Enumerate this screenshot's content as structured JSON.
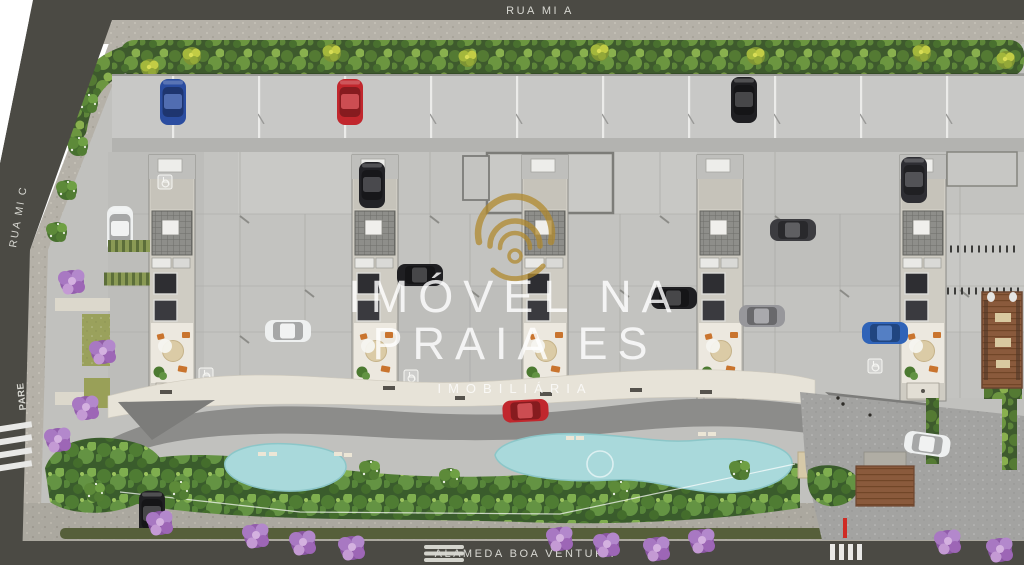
{
  "streets": {
    "top_label": "RUA MI A",
    "left_label": "RUA MI C",
    "bottom_label": "ALAMEDA BOA VENTURA"
  },
  "markings": {
    "stop_text": "PARE"
  },
  "watermark": {
    "line1": "IMÓVEL NA",
    "line2": "PRAIA ES",
    "line3": "IMOBILIÁRIA"
  },
  "colors": {
    "road": "#4b4a44",
    "site_concrete": "#c1c1be",
    "sidewalk": "#b5b1a8",
    "hedge_green": "#4a6c33",
    "lush_green": "#57813a",
    "flower_purple": "#a878c2",
    "pool_blue": "#a9d9db",
    "promenade_cream": "#e7e3d8",
    "patio_cream": "#ece8df",
    "brick_deck": "#8a5a3c",
    "logo_gold": "#b18a2e",
    "car_red": "#c1272d",
    "car_blue": "#2b4da0",
    "street_label_text": "#d8d8d2"
  }
}
